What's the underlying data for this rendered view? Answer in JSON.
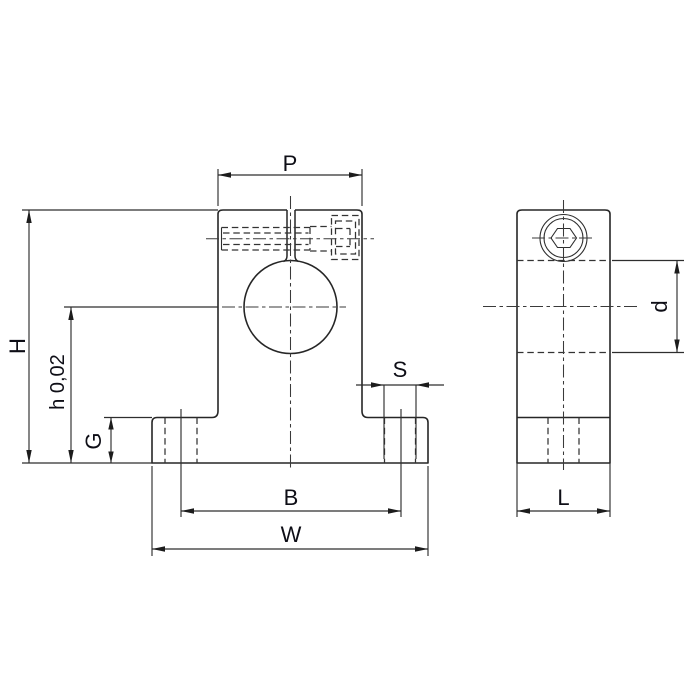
{
  "drawing": {
    "kind": "technical drawing, shaft support block, two orthographic views",
    "background": "#ffffff",
    "line_color": "#262626",
    "text_color": "#0e0e16"
  },
  "dimensions": {
    "P": "P",
    "H": "H",
    "h_tol": "h 0,02",
    "G": "G",
    "S": "S",
    "B": "B",
    "W": "W",
    "d": "d",
    "L": "L"
  }
}
